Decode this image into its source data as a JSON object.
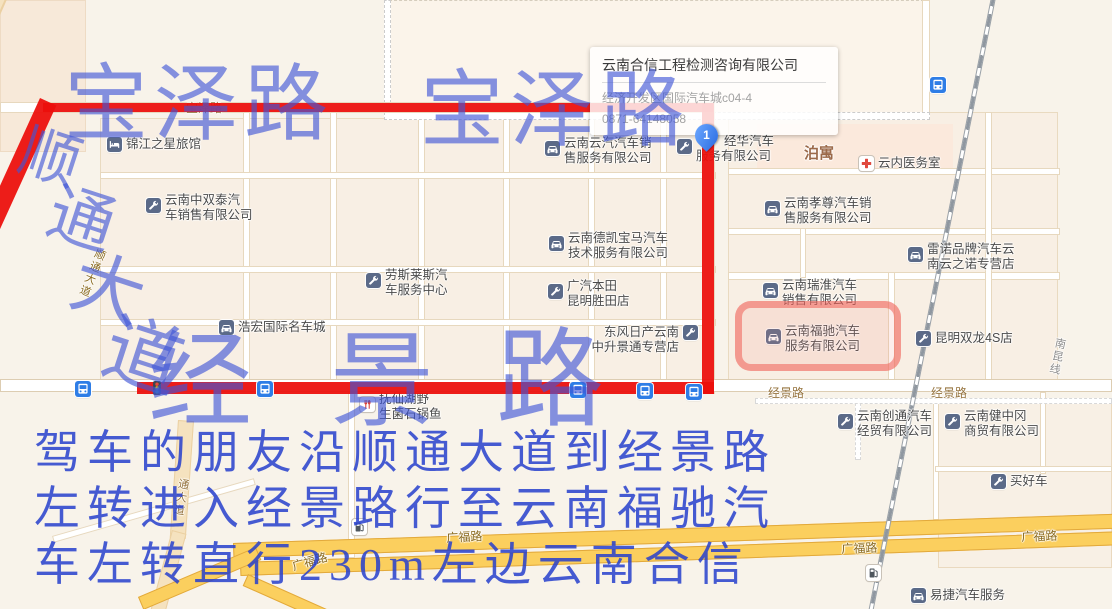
{
  "popup": {
    "title": "云南合信工程检测咨询有限公司",
    "address": "经济开发区国际汽车城c04-4",
    "phone": "0871-64148058"
  },
  "pin": {
    "label": "1"
  },
  "annotations": {
    "baozelu_1": "宝泽路",
    "baozelu_2": "宝泽路",
    "shuntong_chars": [
      {
        "ch": "顺",
        "x": 20,
        "y": 128,
        "size": 60,
        "rot": 18
      },
      {
        "ch": "通",
        "x": 48,
        "y": 188,
        "size": 66,
        "rot": 18
      },
      {
        "ch": "大",
        "x": 72,
        "y": 254,
        "size": 72,
        "rot": 18
      },
      {
        "ch": "道",
        "x": 104,
        "y": 318,
        "size": 78,
        "rot": 18
      }
    ],
    "jingjing_chars": [
      {
        "ch": "经",
        "x": 148,
        "y": 332,
        "size": 104
      },
      {
        "ch": "景",
        "x": 348,
        "y": 330,
        "size": 104
      },
      {
        "ch": "路",
        "x": 532,
        "y": 328,
        "size": 108
      }
    ],
    "directions_lines": [
      "驾车的朋友沿顺通大道到经景路",
      "左转进入经景路行至云南福驰汽",
      "车左转直行230m左边云南合信"
    ],
    "colors": {
      "route_red": "#ec0f0c",
      "annotation_blue": "#3a52d2",
      "highlight_red": "#f15f55"
    }
  },
  "map": {
    "road_labels": [
      {
        "text": "宝泽路",
        "x": 186,
        "y": 99,
        "rot": 0,
        "cls": ""
      },
      {
        "text": "经景路",
        "x": 768,
        "y": 384,
        "rot": 0,
        "cls": ""
      },
      {
        "text": "经景路",
        "x": 931,
        "y": 384,
        "rot": 0,
        "cls": ""
      },
      {
        "text": "广福路",
        "x": 446,
        "y": 529,
        "rot": -3,
        "cls": "hw"
      },
      {
        "text": "广福路",
        "x": 290,
        "y": 558,
        "rot": -16,
        "cls": "hw"
      },
      {
        "text": "广福路",
        "x": 841,
        "y": 540,
        "rot": -2,
        "cls": "hw"
      },
      {
        "text": "广福路",
        "x": 1021,
        "y": 528,
        "rot": -2,
        "cls": "hw"
      },
      {
        "text": "南昆线",
        "x": 1053,
        "y": 336,
        "rot": 12,
        "cls": "rail vertical"
      },
      {
        "text": "通大道",
        "x": 176,
        "y": 477,
        "rot": 10,
        "cls": "vertical"
      },
      {
        "text": "顺通大道",
        "x": 94,
        "y": 246,
        "rot": 22,
        "cls": "hw vertical"
      },
      {
        "text": "泊寓",
        "x": 804,
        "y": 142,
        "rot": 0,
        "cls": "brand"
      }
    ],
    "pois": [
      {
        "icon": "bed-icon",
        "x": 107,
        "y": 137,
        "lines": [
          "锦江之星旅馆"
        ]
      },
      {
        "icon": "wrench-icon",
        "x": 146,
        "y": 198,
        "lines": [
          "云南中双泰汽",
          "车销售有限公司"
        ]
      },
      {
        "icon": "car-icon",
        "x": 545,
        "y": 141,
        "lines": [
          "云南云汽汽车销",
          "售服务有限公司"
        ]
      },
      {
        "icon": "wrench-icon",
        "x": 677,
        "y": 139,
        "lines": [
          "经华汽车",
          "服务有限公司"
        ],
        "indent": 28
      },
      {
        "icon": "medical-icon",
        "x": 859,
        "y": 156,
        "lines": [
          "云内医务室"
        ]
      },
      {
        "icon": "car-icon",
        "x": 765,
        "y": 201,
        "lines": [
          "云南孝尊汽车销",
          "售服务有限公司"
        ]
      },
      {
        "icon": "car-icon",
        "x": 908,
        "y": 247,
        "lines": [
          "雷诺品牌汽车云",
          "南云之诺专营店"
        ]
      },
      {
        "icon": "car-icon",
        "x": 549,
        "y": 236,
        "lines": [
          "云南德凯宝马汽车",
          "技术服务有限公司"
        ]
      },
      {
        "icon": "wrench-icon",
        "x": 548,
        "y": 284,
        "lines": [
          "广汽本田",
          "昆明胜田店"
        ]
      },
      {
        "icon": "car-icon",
        "x": 763,
        "y": 283,
        "lines": [
          "云南瑞淮汽车",
          "销售有限公司"
        ]
      },
      {
        "icon": "car-icon",
        "x": 766,
        "y": 329,
        "lines": [
          "云南福驰汽车",
          "服务有限公司"
        ]
      },
      {
        "icon": "wrench-icon",
        "x": 916,
        "y": 331,
        "lines": [
          "昆明双龙4S店"
        ]
      },
      {
        "icon": "wrench-icon",
        "x": 366,
        "y": 273,
        "lines": [
          "劳斯莱斯汽",
          "车服务中心"
        ]
      },
      {
        "icon": "car-icon",
        "x": 219,
        "y": 320,
        "lines": [
          "浩宏国际名车城"
        ]
      },
      {
        "icon": "wrench-icon",
        "x": 683,
        "y": 334,
        "lines": [
          "东风日产云南",
          "中升景通专营店"
        ],
        "side": "left"
      },
      {
        "icon": "restaurant-icon",
        "x": 360,
        "y": 397,
        "lines": [
          "抚仙湖野",
          "生菌石锅鱼"
        ]
      },
      {
        "icon": "wrench-icon",
        "x": 838,
        "y": 414,
        "lines": [
          "云南创通汽车",
          "经贸有限公司"
        ]
      },
      {
        "icon": "wrench-icon",
        "x": 945,
        "y": 414,
        "lines": [
          "云南健中冈",
          "商贸有限公司"
        ]
      },
      {
        "icon": "wrench-icon",
        "x": 991,
        "y": 474,
        "lines": [
          "买好车"
        ]
      },
      {
        "icon": "car-icon",
        "x": 911,
        "y": 588,
        "lines": [
          "易捷汽车服务"
        ]
      }
    ],
    "bus_stops": [
      [
        75,
        381
      ],
      [
        257,
        381
      ],
      [
        570,
        382
      ],
      [
        637,
        383
      ],
      [
        686,
        384
      ],
      [
        930,
        77
      ]
    ],
    "gas_stations": [
      [
        352,
        519
      ],
      [
        866,
        565
      ]
    ],
    "traffic_lights": [
      [
        152,
        380
      ]
    ]
  }
}
